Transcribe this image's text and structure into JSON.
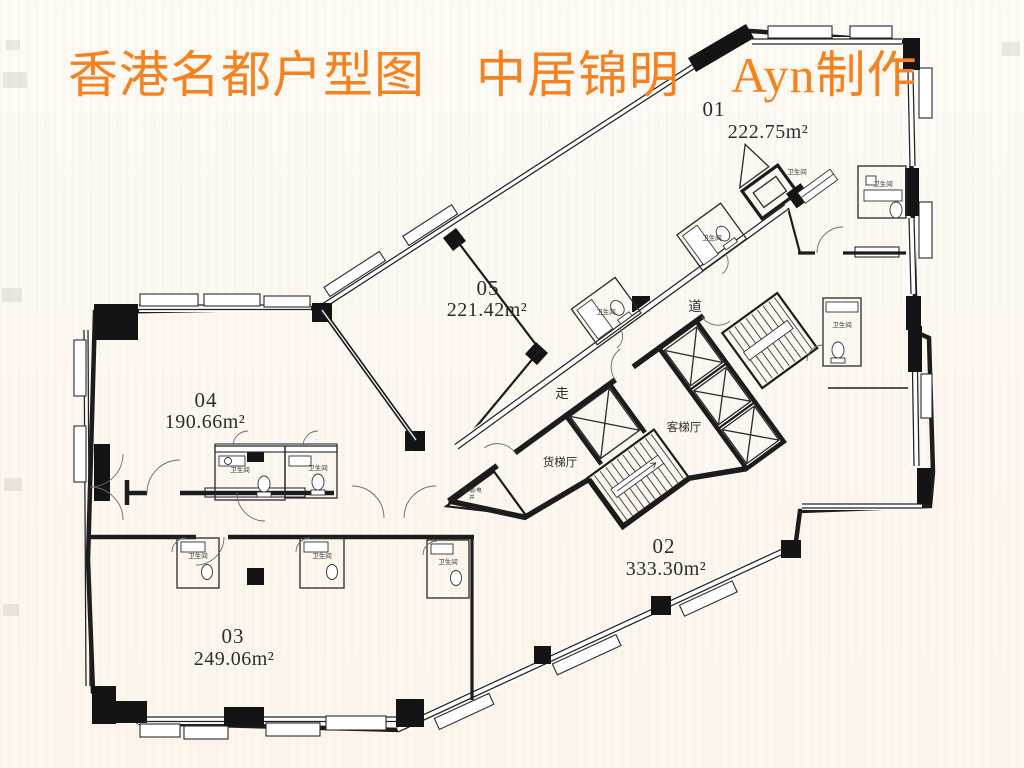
{
  "title": "香港名都户型图　中居锦明　Ayn制作",
  "colors": {
    "title": "#F5821F",
    "wall": "#1a1a1a",
    "background": "#fcf8f2"
  },
  "units": [
    {
      "id": "01",
      "area": "222.75m²"
    },
    {
      "id": "02",
      "area": "333.30m²"
    },
    {
      "id": "03",
      "area": "249.06m²"
    },
    {
      "id": "04",
      "area": "190.66m²"
    },
    {
      "id": "05",
      "area": "221.42m²"
    }
  ],
  "core": {
    "freight_hall": "货梯厅",
    "passenger_hall": "客梯厅",
    "corridor_char_a": "道",
    "corridor_char_b": "走"
  },
  "rooms": {
    "bathroom": "卫生间",
    "shaft_line1": "强/弱/电",
    "shaft_line2": "井"
  }
}
